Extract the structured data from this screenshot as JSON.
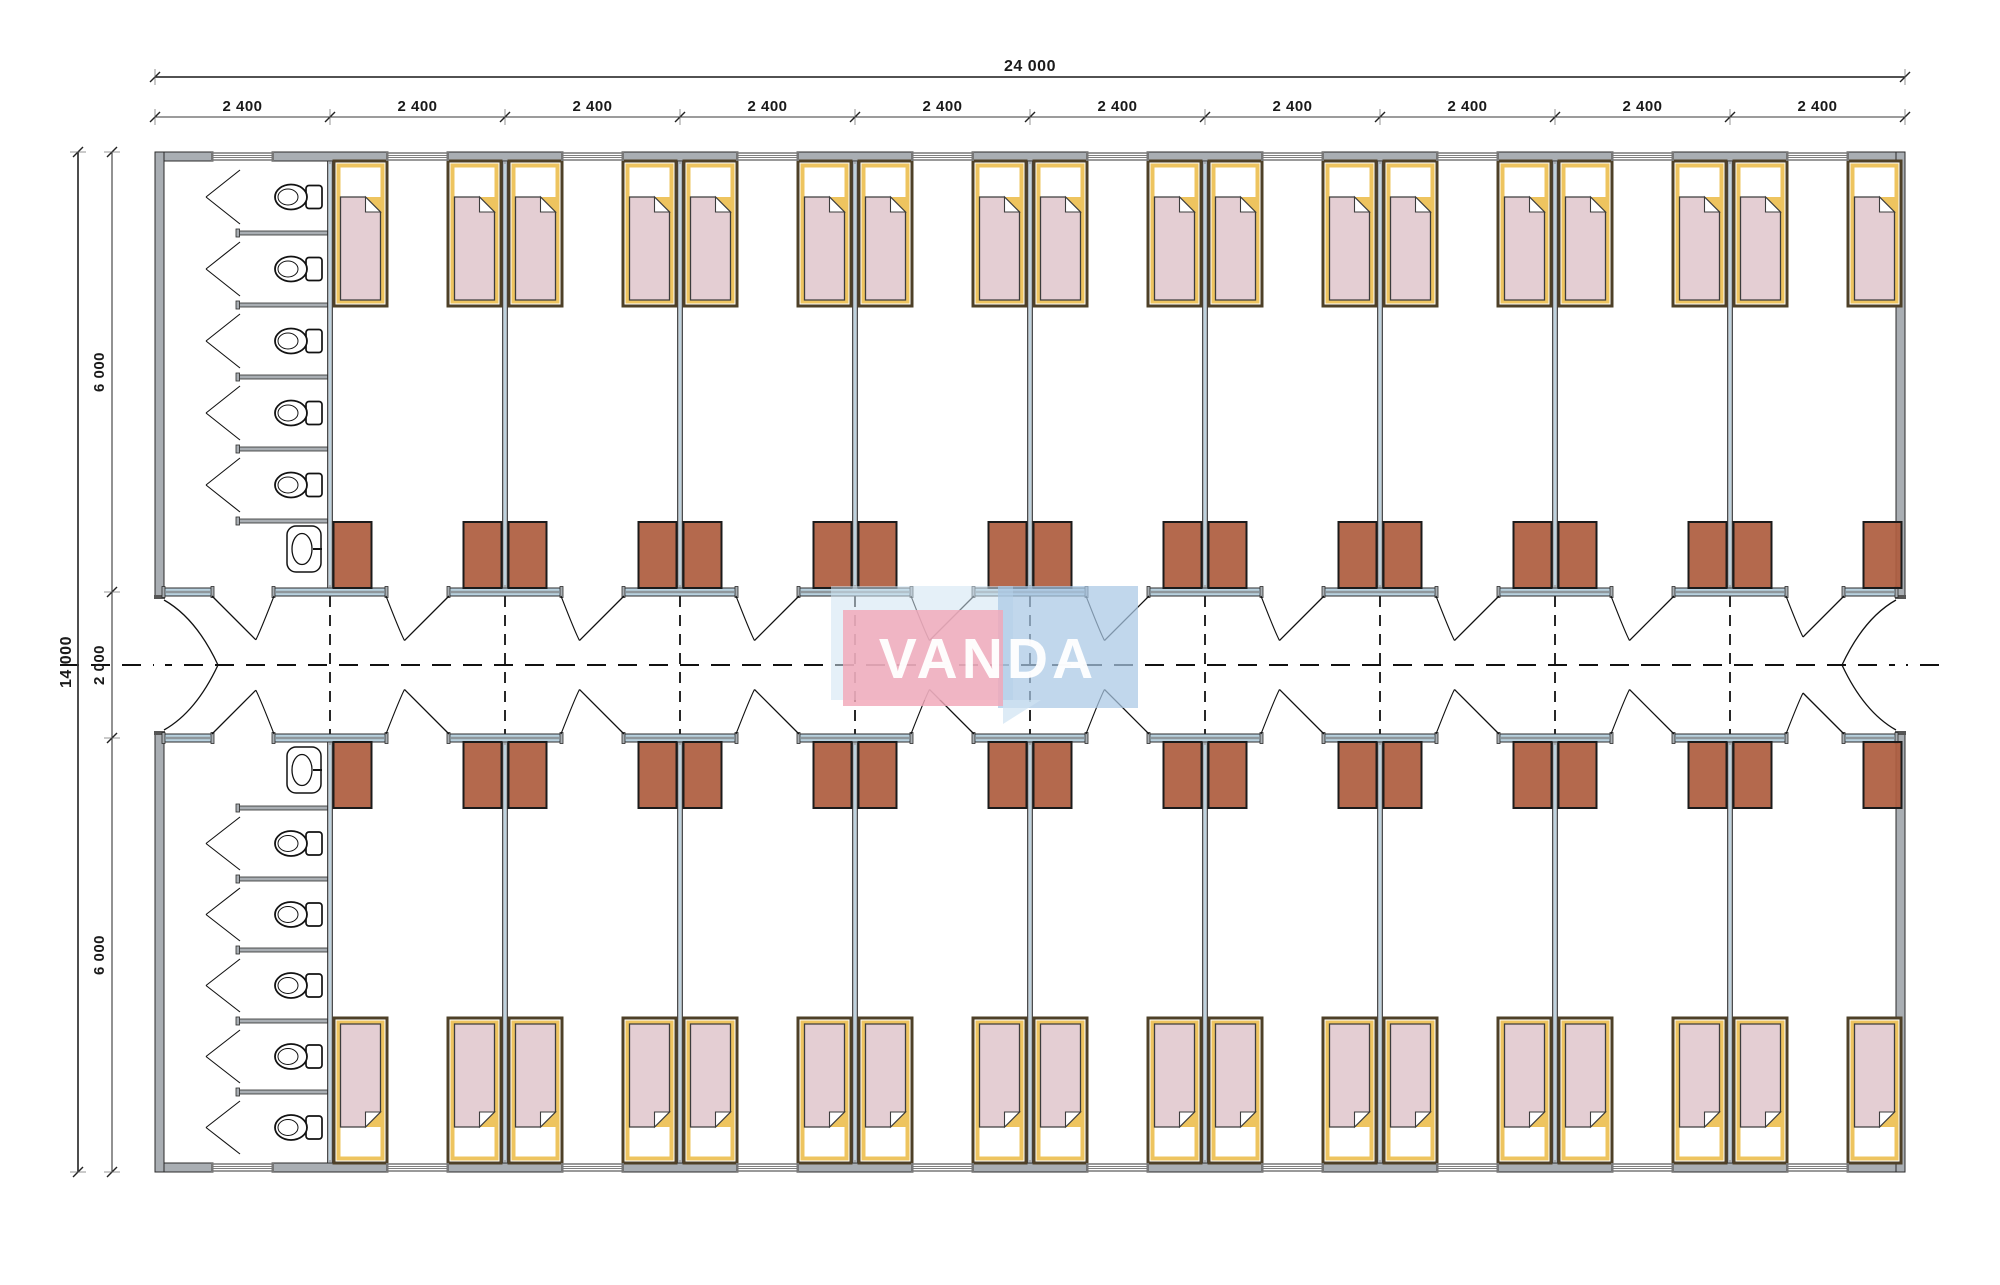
{
  "page": {
    "background": "#ffffff",
    "description": "Architectural floor plan of a modular dormitory building with central corridor, bedrooms and sanitary blocks"
  },
  "watermark": {
    "text": "VANDA",
    "pink": "#f2a7b8",
    "blue": "#a9c7e4",
    "light_blue": "#cfe3f2",
    "text_color": "#ffffff"
  },
  "dimensions": {
    "overall_width_label": "24 000",
    "bay_labels": [
      "2 400",
      "2 400",
      "2 400",
      "2 400",
      "2 400",
      "2 400",
      "2 400",
      "2 400",
      "2 400",
      "2 400"
    ],
    "overall_height_label": "14 000",
    "height_segment_labels": [
      "6 000",
      "2 000",
      "6 000"
    ]
  },
  "plan": {
    "bay_count": 10,
    "bay_mm": 2400,
    "width_mm": 24000,
    "height_mm": 14000,
    "room_depth_mm": 6000,
    "corridor_mm": 2000,
    "rooms_per_row": 9,
    "beds_per_room": 2,
    "wardrobes_per_room": 2,
    "bathrooms": 2,
    "toilet_stalls_per_bathroom": 5,
    "sinks_per_bathroom": 1
  },
  "colors": {
    "wall_fill": "#a9aeb3",
    "wall_edge": "#2b2b2b",
    "wall_accent": "#c3dbe8",
    "corridor_wall_fill": "#b9d2e0",
    "corridor_wall_core": "#8f979c",
    "bed_frame": "#4e4027",
    "bed_trim": "#eec45f",
    "bed_blanket": "#e4ced3",
    "bed_sheet": "#ffffff",
    "blanket_edge": "#3d3d3d",
    "wardrobe": "#ae5e3f",
    "wardrobe_edge": "#1b1b1b",
    "fixture_stroke": "#121212",
    "door_stroke": "#111111",
    "dash": "#111111",
    "dim_line": "#3a3a3a",
    "dim_tick": "#222222"
  }
}
